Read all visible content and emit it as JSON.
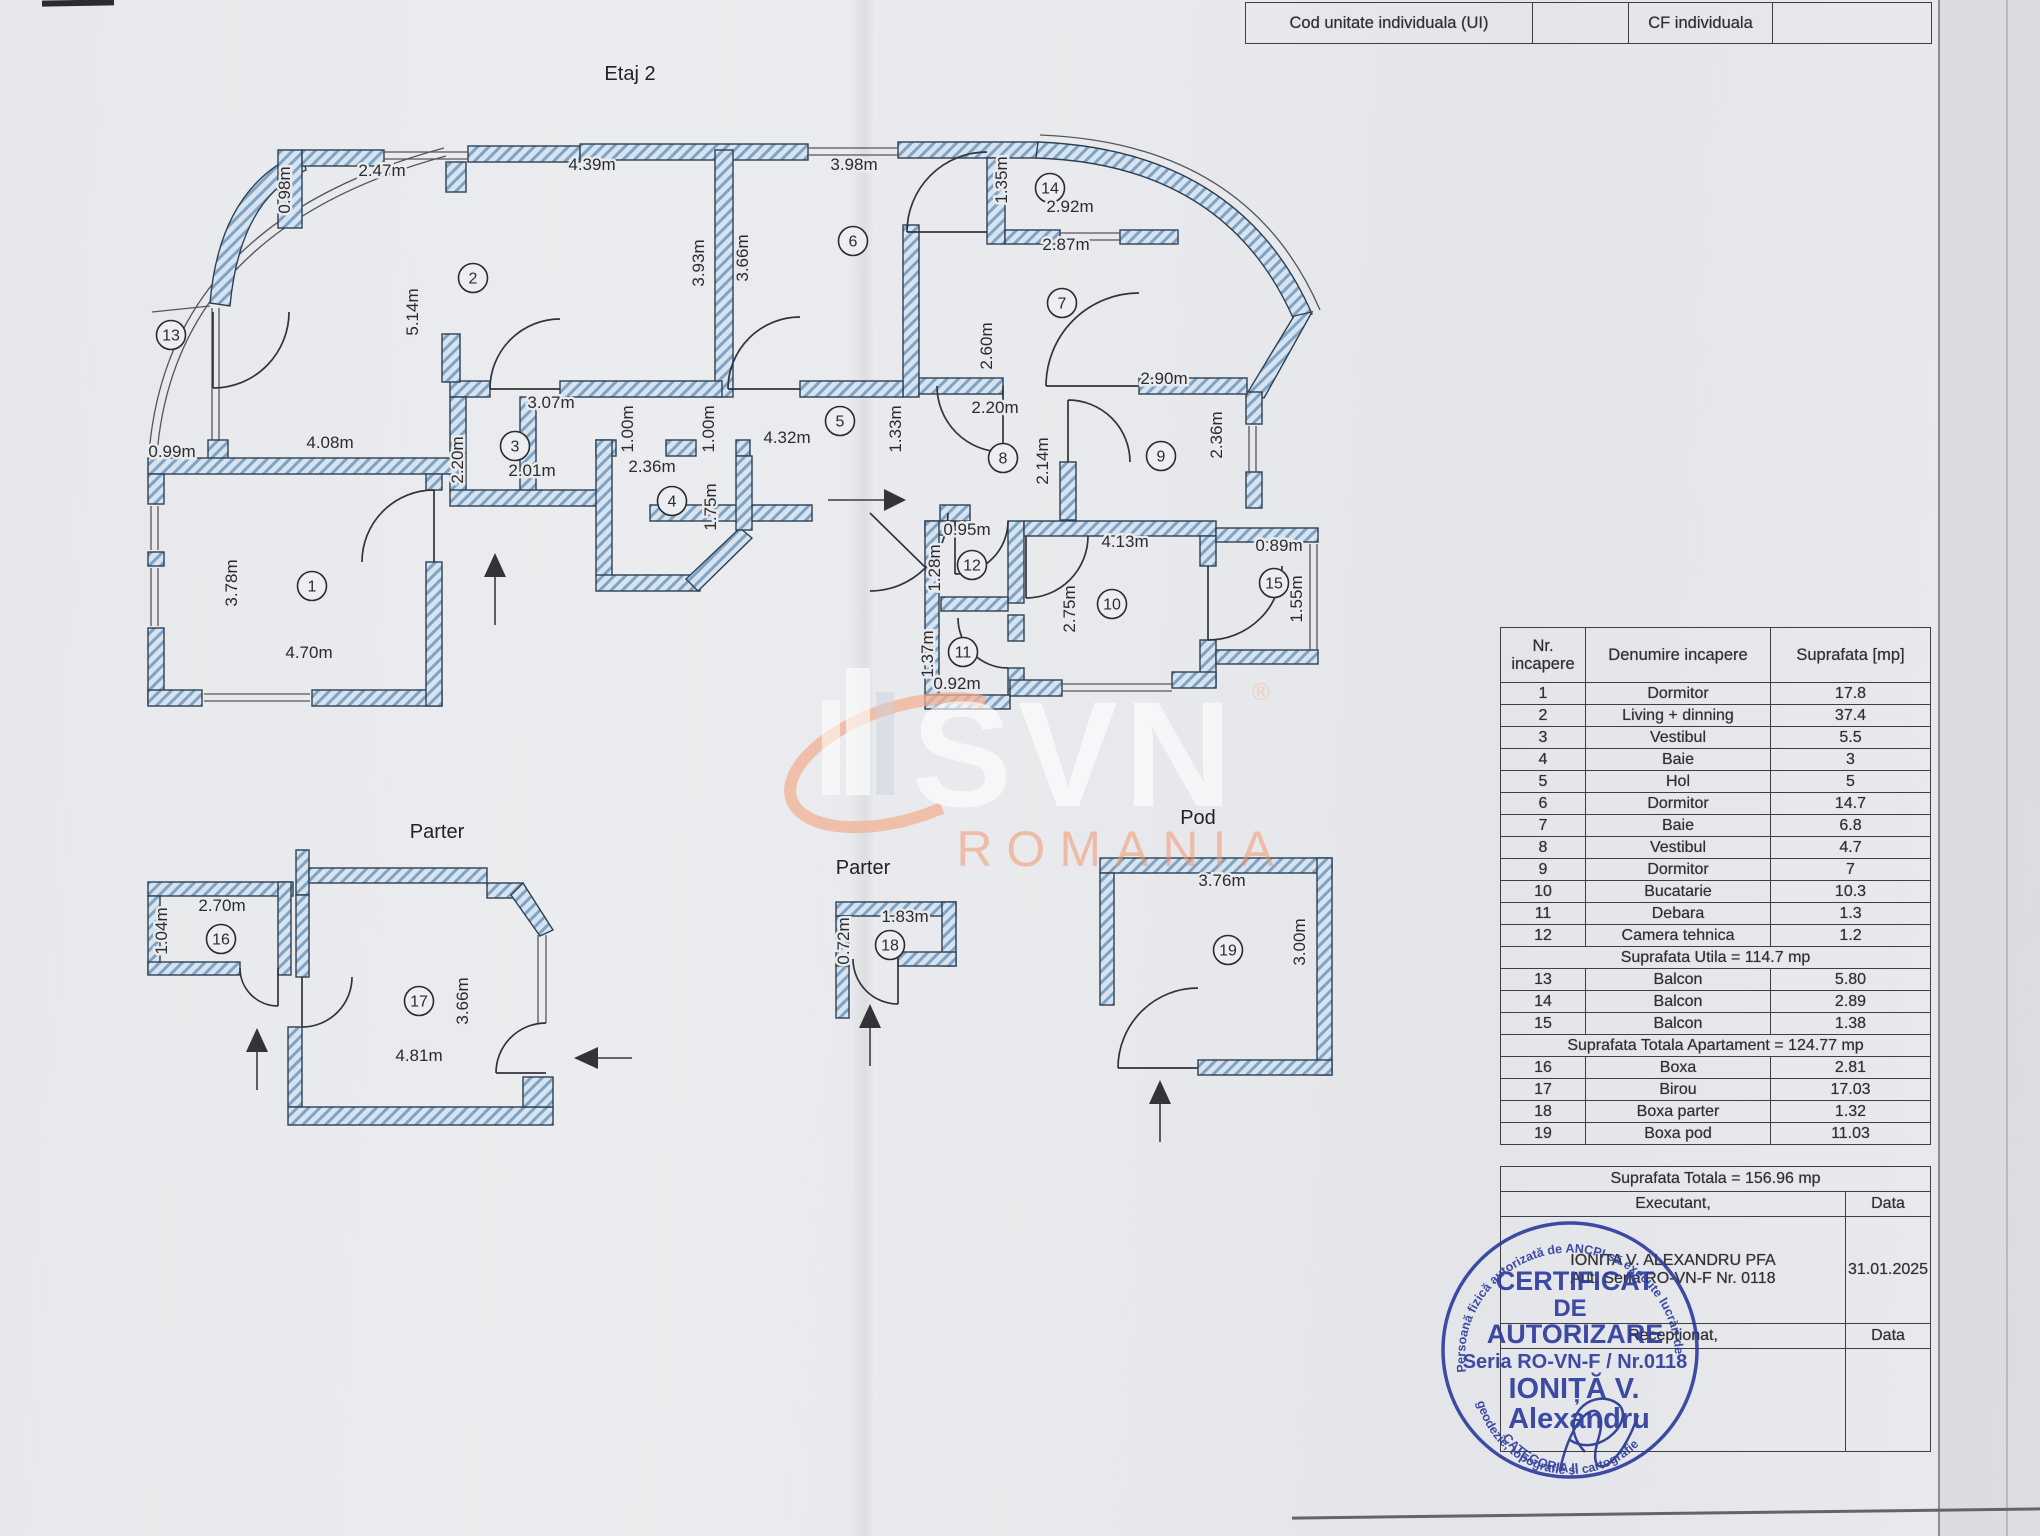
{
  "top_table": {
    "cells": [
      "Cod unitate individuala (UI)",
      "",
      "CF individuala",
      ""
    ]
  },
  "plans": {
    "etaj2": {
      "title": "Etaj 2",
      "labels": [
        {
          "t": "0.98m",
          "x": 290,
          "y": 190,
          "r": 1
        },
        {
          "t": "2.47m",
          "x": 382,
          "y": 176
        },
        {
          "t": "4.39m",
          "x": 592,
          "y": 170
        },
        {
          "t": "3.98m",
          "x": 854,
          "y": 170
        },
        {
          "t": "1.35m",
          "x": 1007,
          "y": 180,
          "r": 1
        },
        {
          "t": "14",
          "x": 1050,
          "y": 188,
          "c": 1
        },
        {
          "t": "2.92m",
          "x": 1070,
          "y": 212
        },
        {
          "t": "2.87m",
          "x": 1066,
          "y": 250
        },
        {
          "t": "2",
          "x": 473,
          "y": 278,
          "c": 1
        },
        {
          "t": "5.14m",
          "x": 418,
          "y": 312,
          "r": 1
        },
        {
          "t": "3.93m",
          "x": 704,
          "y": 263,
          "r": 1
        },
        {
          "t": "3.66m",
          "x": 748,
          "y": 258,
          "r": 1
        },
        {
          "t": "6",
          "x": 853,
          "y": 241,
          "c": 1
        },
        {
          "t": "7",
          "x": 1062,
          "y": 303,
          "c": 1
        },
        {
          "t": "2.60m",
          "x": 992,
          "y": 346,
          "r": 1
        },
        {
          "t": "2.90m",
          "x": 1164,
          "y": 384
        },
        {
          "t": "3.07m",
          "x": 551,
          "y": 408
        },
        {
          "t": "2.20m",
          "x": 463,
          "y": 460,
          "r": 1
        },
        {
          "t": "3",
          "x": 515,
          "y": 446,
          "c": 1
        },
        {
          "t": "2.01m",
          "x": 532,
          "y": 476
        },
        {
          "t": "4.08m",
          "x": 330,
          "y": 448
        },
        {
          "t": "0.99m",
          "x": 172,
          "y": 457
        },
        {
          "t": "1.00m",
          "x": 633,
          "y": 429,
          "r": 1
        },
        {
          "t": "1.00m",
          "x": 714,
          "y": 429,
          "r": 1
        },
        {
          "t": "5",
          "x": 840,
          "y": 421,
          "c": 1
        },
        {
          "t": "4.32m",
          "x": 787,
          "y": 443
        },
        {
          "t": "1.33m",
          "x": 901,
          "y": 429,
          "r": 1
        },
        {
          "t": "2.20m",
          "x": 995,
          "y": 413
        },
        {
          "t": "8",
          "x": 1003,
          "y": 458,
          "c": 1
        },
        {
          "t": "2.14m",
          "x": 1048,
          "y": 461,
          "r": 1
        },
        {
          "t": "9",
          "x": 1161,
          "y": 456,
          "c": 1
        },
        {
          "t": "2.36m",
          "x": 1222,
          "y": 435,
          "r": 1
        },
        {
          "t": "2.36m",
          "x": 652,
          "y": 472
        },
        {
          "t": "4",
          "x": 672,
          "y": 501,
          "c": 1
        },
        {
          "t": "1.75m",
          "x": 716,
          "y": 507,
          "r": 1
        },
        {
          "t": "0.95m",
          "x": 967,
          "y": 535
        },
        {
          "t": "12",
          "x": 972,
          "y": 565,
          "c": 1
        },
        {
          "t": "1.28m",
          "x": 940,
          "y": 568,
          "r": 1
        },
        {
          "t": "4.13m",
          "x": 1125,
          "y": 547
        },
        {
          "t": "10",
          "x": 1112,
          "y": 604,
          "c": 1
        },
        {
          "t": "2.75m",
          "x": 1075,
          "y": 609,
          "r": 1
        },
        {
          "t": "0.89m",
          "x": 1279,
          "y": 551
        },
        {
          "t": "15",
          "x": 1274,
          "y": 583,
          "c": 1
        },
        {
          "t": "1.55m",
          "x": 1302,
          "y": 599,
          "r": 1
        },
        {
          "t": "11",
          "x": 963,
          "y": 652,
          "c": 1
        },
        {
          "t": "1.37m",
          "x": 933,
          "y": 654,
          "r": 1
        },
        {
          "t": "0.92m",
          "x": 957,
          "y": 689
        },
        {
          "t": "13",
          "x": 171,
          "y": 335,
          "c": 1
        },
        {
          "t": "1",
          "x": 312,
          "y": 586,
          "c": 1
        },
        {
          "t": "3.78m",
          "x": 237,
          "y": 583,
          "r": 1
        },
        {
          "t": "4.70m",
          "x": 309,
          "y": 658
        }
      ]
    },
    "parter_left": {
      "title": "Parter",
      "labels": [
        {
          "t": "2.70m",
          "x": 222,
          "y": 911
        },
        {
          "t": "1.04m",
          "x": 167,
          "y": 931,
          "r": 1
        },
        {
          "t": "16",
          "x": 221,
          "y": 939,
          "c": 1
        },
        {
          "t": "17",
          "x": 419,
          "y": 1001,
          "c": 1
        },
        {
          "t": "3.66m",
          "x": 468,
          "y": 1001,
          "r": 1
        },
        {
          "t": "4.81m",
          "x": 419,
          "y": 1061
        }
      ]
    },
    "parter_mid": {
      "title": "Parter",
      "labels": [
        {
          "t": "1.83m",
          "x": 905,
          "y": 922
        },
        {
          "t": "0.72m",
          "x": 849,
          "y": 941,
          "r": 1
        },
        {
          "t": "18",
          "x": 890,
          "y": 945,
          "c": 1
        }
      ]
    },
    "pod": {
      "title": "Pod",
      "labels": [
        {
          "t": "3.76m",
          "x": 1222,
          "y": 886
        },
        {
          "t": "19",
          "x": 1228,
          "y": 950,
          "c": 1
        },
        {
          "t": "3.00m",
          "x": 1305,
          "y": 942,
          "r": 1
        }
      ]
    }
  },
  "watermark": {
    "mark": "SVN",
    "reg": "®",
    "sub": "ROMANIA"
  },
  "areas_table": {
    "headers": [
      "Nr. incapere",
      "Denumire incapere",
      "Suprafata [mp]"
    ],
    "rows": [
      {
        "nr": "1",
        "name": "Dormitor",
        "area": "17.8"
      },
      {
        "nr": "2",
        "name": "Living + dinning",
        "area": "37.4"
      },
      {
        "nr": "3",
        "name": "Vestibul",
        "area": "5.5"
      },
      {
        "nr": "4",
        "name": "Baie",
        "area": "3"
      },
      {
        "nr": "5",
        "name": "Hol",
        "area": "5"
      },
      {
        "nr": "6",
        "name": "Dormitor",
        "area": "14.7"
      },
      {
        "nr": "7",
        "name": "Baie",
        "area": "6.8"
      },
      {
        "nr": "8",
        "name": "Vestibul",
        "area": "4.7"
      },
      {
        "nr": "9",
        "name": "Dormitor",
        "area": "7"
      },
      {
        "nr": "10",
        "name": "Bucatarie",
        "area": "10.3"
      },
      {
        "nr": "11",
        "name": "Debara",
        "area": "1.3"
      },
      {
        "nr": "12",
        "name": "Camera tehnica",
        "area": "1.2"
      },
      {
        "span": "Suprafata Utila = 114.7 mp"
      },
      {
        "nr": "13",
        "name": "Balcon",
        "area": "5.80"
      },
      {
        "nr": "14",
        "name": "Balcon",
        "area": "2.89"
      },
      {
        "nr": "15",
        "name": "Balcon",
        "area": "1.38"
      },
      {
        "span": "Suprafata Totala Apartament = 124.77 mp"
      },
      {
        "nr": "16",
        "name": "Boxa",
        "area": "2.81"
      },
      {
        "nr": "17",
        "name": "Birou",
        "area": "17.03"
      },
      {
        "nr": "18",
        "name": "Boxa parter",
        "area": "1.32"
      },
      {
        "nr": "19",
        "name": "Boxa pod",
        "area": "11.03"
      }
    ]
  },
  "footer_table": {
    "total": "Suprafata Totala = 156.96 mp",
    "executant_label": "Executant,",
    "data_label": "Data",
    "executant_line1": "IONITA V. ALEXANDRU PFA",
    "executant_line2": "Aut. Seria RO-VN-F Nr. 0118",
    "date": "31.01.2025",
    "receptionat_label": "Receptionat,",
    "data_label2": "Data"
  },
  "stamp": {
    "l1": "CERTIFICAT",
    "l2": "DE",
    "l3": "AUTORIZARE",
    "l4": "Seria RO-VN-F / Nr.0118",
    "l5": "IONIȚĂ V.",
    "l6": "Alexandru",
    "ring_top": "Persoană fizică autorizată de ANCPI să execute lucrări de",
    "ring_bottom": "geodezie, topografie şi cartografie",
    "categoria": "CATEGORIA II"
  },
  "colors": {
    "wall_hatch": "#7fa3c4",
    "wall_bg": "#d7e3ef",
    "line": "#2e3f52",
    "stamp_blue": "#2b3a9c",
    "watermark_orange": "#f0985f",
    "paper": "#e9eaed"
  }
}
